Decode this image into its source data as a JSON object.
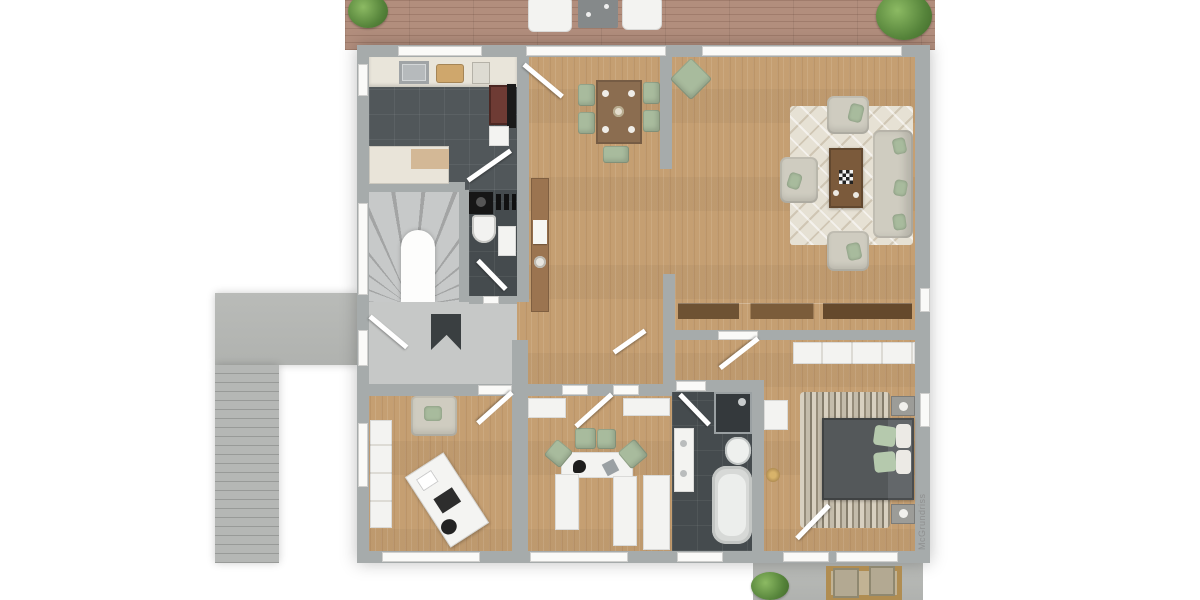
{
  "watermark": {
    "text": "McGrundriss"
  },
  "palette": {
    "background": "#ffffff",
    "wall": "#a6abab",
    "wood_floor": "#c59f72",
    "deck_wood": "#b28e7d",
    "dark_tile": "#51575a",
    "hall_floor": "#c6c8c7",
    "concrete": "#b7b9b8",
    "living_rug": "#e6e1d4",
    "sofa_beige": "#cfccc0",
    "accent_green": "#a8bb9d",
    "furniture_brown": "#7b5a3b",
    "bed_gray": "#595d5f",
    "fixture_white": "#f3f3f1"
  },
  "floorplan": {
    "type": "residential-floor-plan-top-view",
    "rooms": [
      {
        "name": "terrace-deck",
        "furniture": [
          "sun-lounger",
          "sun-lounger",
          "side-table",
          "bush",
          "bush"
        ]
      },
      {
        "name": "kitchen",
        "furniture": [
          "counter-with-sink",
          "cutting-board",
          "tall-oven-unit",
          "island-counter"
        ]
      },
      {
        "name": "dining-area",
        "furniture": [
          "dining-table",
          "chair",
          "chair",
          "chair",
          "chair",
          "chair"
        ]
      },
      {
        "name": "living-room",
        "furniture": [
          "area-rug",
          "sofa",
          "armchair",
          "armchair",
          "armchair",
          "coffee-table",
          "sideboard",
          "plant",
          "lounge-cushion"
        ]
      },
      {
        "name": "staircase",
        "furniture": [
          "winder-stairs",
          "arched-niche"
        ]
      },
      {
        "name": "entrance-hall",
        "furniture": [
          "doormat",
          "front-door"
        ]
      },
      {
        "name": "wc",
        "furniture": [
          "washing-machine",
          "toilet",
          "washbasin"
        ]
      },
      {
        "name": "hallway",
        "furniture": [
          "console-table",
          "plant",
          "plant"
        ]
      },
      {
        "name": "office",
        "furniture": [
          "wardrobe",
          "armchair",
          "desk",
          "desk-chair",
          "plant"
        ]
      },
      {
        "name": "study-nook",
        "furniture": [
          "cabinet",
          "cabinet",
          "u-shaped-desk",
          "chair",
          "chair",
          "chair",
          "chair",
          "tall-cabinet",
          "plant"
        ]
      },
      {
        "name": "bathroom",
        "furniture": [
          "vanity-sink",
          "shower",
          "toilet",
          "bathtub"
        ]
      },
      {
        "name": "bedroom",
        "furniture": [
          "wardrobe",
          "double-bed",
          "pillows",
          "shag-rug",
          "nightstand",
          "nightstand",
          "dresser",
          "plant",
          "candles"
        ]
      },
      {
        "name": "patio",
        "furniture": [
          "outdoor-rug",
          "outdoor-chair",
          "outdoor-chair",
          "bush"
        ]
      },
      {
        "name": "exterior-walkway",
        "furniture": [
          "steps"
        ]
      }
    ]
  }
}
